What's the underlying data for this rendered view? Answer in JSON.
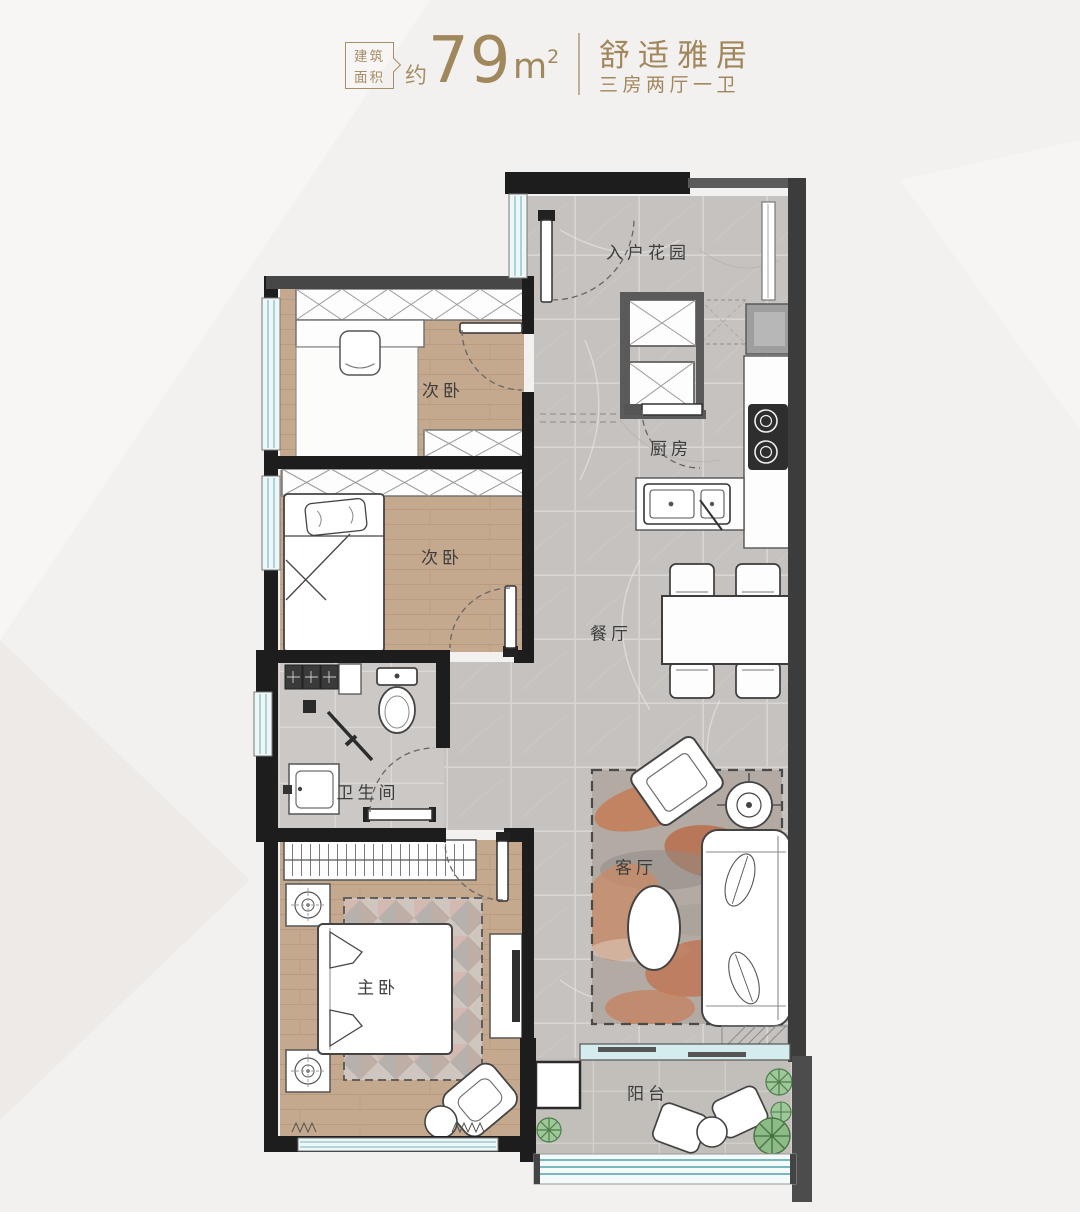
{
  "header": {
    "area_badge": {
      "line1": "建筑",
      "line2": "面积"
    },
    "area_approx": "约",
    "area_value": "79",
    "area_unit": "m",
    "area_exponent": "2",
    "title": "舒适雅居",
    "subtitle": "三房两厅一卫"
  },
  "rooms": [
    {
      "id": "entry-garden",
      "label": "入户花园"
    },
    {
      "id": "bedroom-upper",
      "label": "次卧"
    },
    {
      "id": "kitchen",
      "label": "厨房"
    },
    {
      "id": "bedroom-middle",
      "label": "次卧"
    },
    {
      "id": "dining-room",
      "label": "餐厅"
    },
    {
      "id": "bathroom",
      "label": "卫生间"
    },
    {
      "id": "living-room",
      "label": "客厅"
    },
    {
      "id": "master-bedroom",
      "label": "主卧"
    },
    {
      "id": "balcony",
      "label": "阳台"
    }
  ],
  "colors": {
    "accent_gold": "#a1875c",
    "wall_black": "#1d1d1d",
    "wall_gray": "#4f4f4f",
    "tile_floor": "#c6c2bf",
    "wood_floor": "#c4a98e",
    "window_glass": "#d5ecef",
    "rug_terracotta": "#c0754f",
    "plant_green": "#8fbe8a"
  }
}
